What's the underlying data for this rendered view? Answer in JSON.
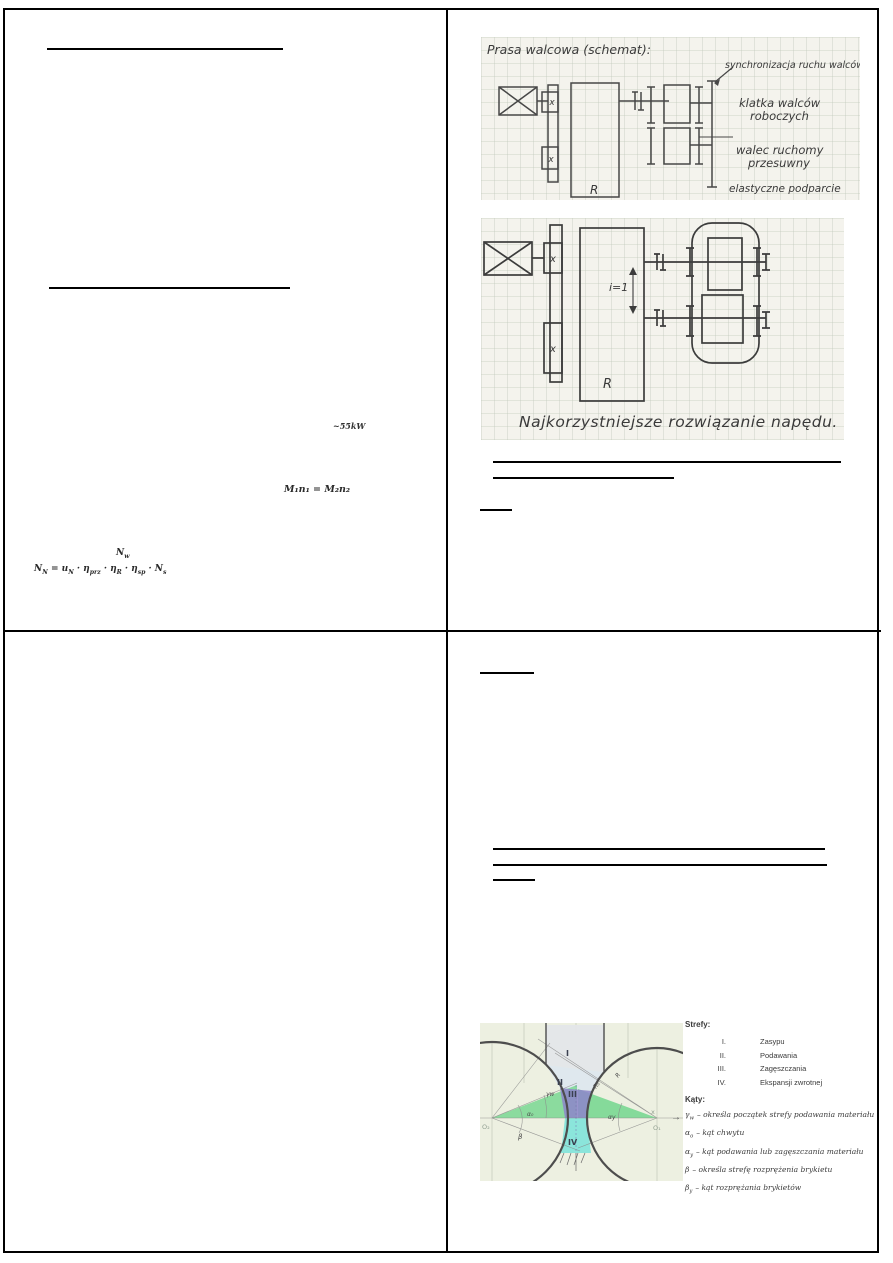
{
  "top_left": {
    "power_note": "~55kW",
    "moment_formula": "M₁n₁ = M₂n₂",
    "nw_formula": [
      "N",
      "w"
    ],
    "drive_formula": [
      "N",
      "N",
      " = u",
      "N",
      " · η",
      "prz",
      " · η",
      "R",
      " · η",
      "sp",
      " · N",
      "s"
    ]
  },
  "figure_roll_press_schematic": {
    "title": "Prasa walcowa (schemat):",
    "label_sync": "synchronizacja ruchu walców",
    "label_stand_line1": "klatka walców",
    "label_stand_line2": "roboczych",
    "label_roll_line1": "walec ruchomy",
    "label_roll_line2": "przesuwny",
    "label_support": "elastyczne podparcie",
    "label_gearbox": "R",
    "label_coupling": "x"
  },
  "figure_drive_solution": {
    "label_ratio": "i=1",
    "label_gearbox": "R",
    "label_coupling": "x",
    "caption": "Najkorzystniejsze rozwiązanie napędu."
  },
  "zones_figure": {
    "diagram": {
      "zone_1": "I",
      "zone_2": "II",
      "zone_3": "III",
      "zone_4": "IV",
      "center_left": "O₂",
      "center_right": "O₁",
      "radius_label_1": "R",
      "radius_label_2": "R₀",
      "axis_label": "x",
      "angle_gamma": "γw",
      "angle_alpha": "α₀",
      "angle_alpha_right": "αy",
      "angle_beta": "β",
      "axis_arrow": "→"
    },
    "colors": {
      "paper": "#edf0e1",
      "zone_1_fill": "#e4e6e9",
      "zone_2_fill": "#dce6f0",
      "zone_3_fill": "#8d87c9",
      "zone_4_fill": "#7fe3da",
      "feed_green": "#79d792"
    },
    "legend": {
      "zones_title": "Strefy:",
      "zones": [
        {
          "num": "I.",
          "label": "Zasypu"
        },
        {
          "num": "II.",
          "label": "Podawania"
        },
        {
          "num": "III.",
          "label": "Zagęszczania"
        },
        {
          "num": "IV.",
          "label": "Ekspansji zwrotnej"
        }
      ],
      "angles_title": "Kąty:",
      "angles": [
        {
          "sym": "γ",
          "sub": "w",
          "desc": "– określa początek strefy podawania materiału"
        },
        {
          "sym": "α",
          "sub": "o",
          "desc": "– kąt chwytu"
        },
        {
          "sym": "α",
          "sub": "y",
          "desc": "– kąt podawania lub zagęszczania materiału"
        },
        {
          "sym": "β",
          "sub": "",
          "desc": "– określa strefę rozprężenia brykietu"
        },
        {
          "sym": "β",
          "sub": "y",
          "desc": "– kąt rozprężania brykietów"
        }
      ]
    }
  }
}
